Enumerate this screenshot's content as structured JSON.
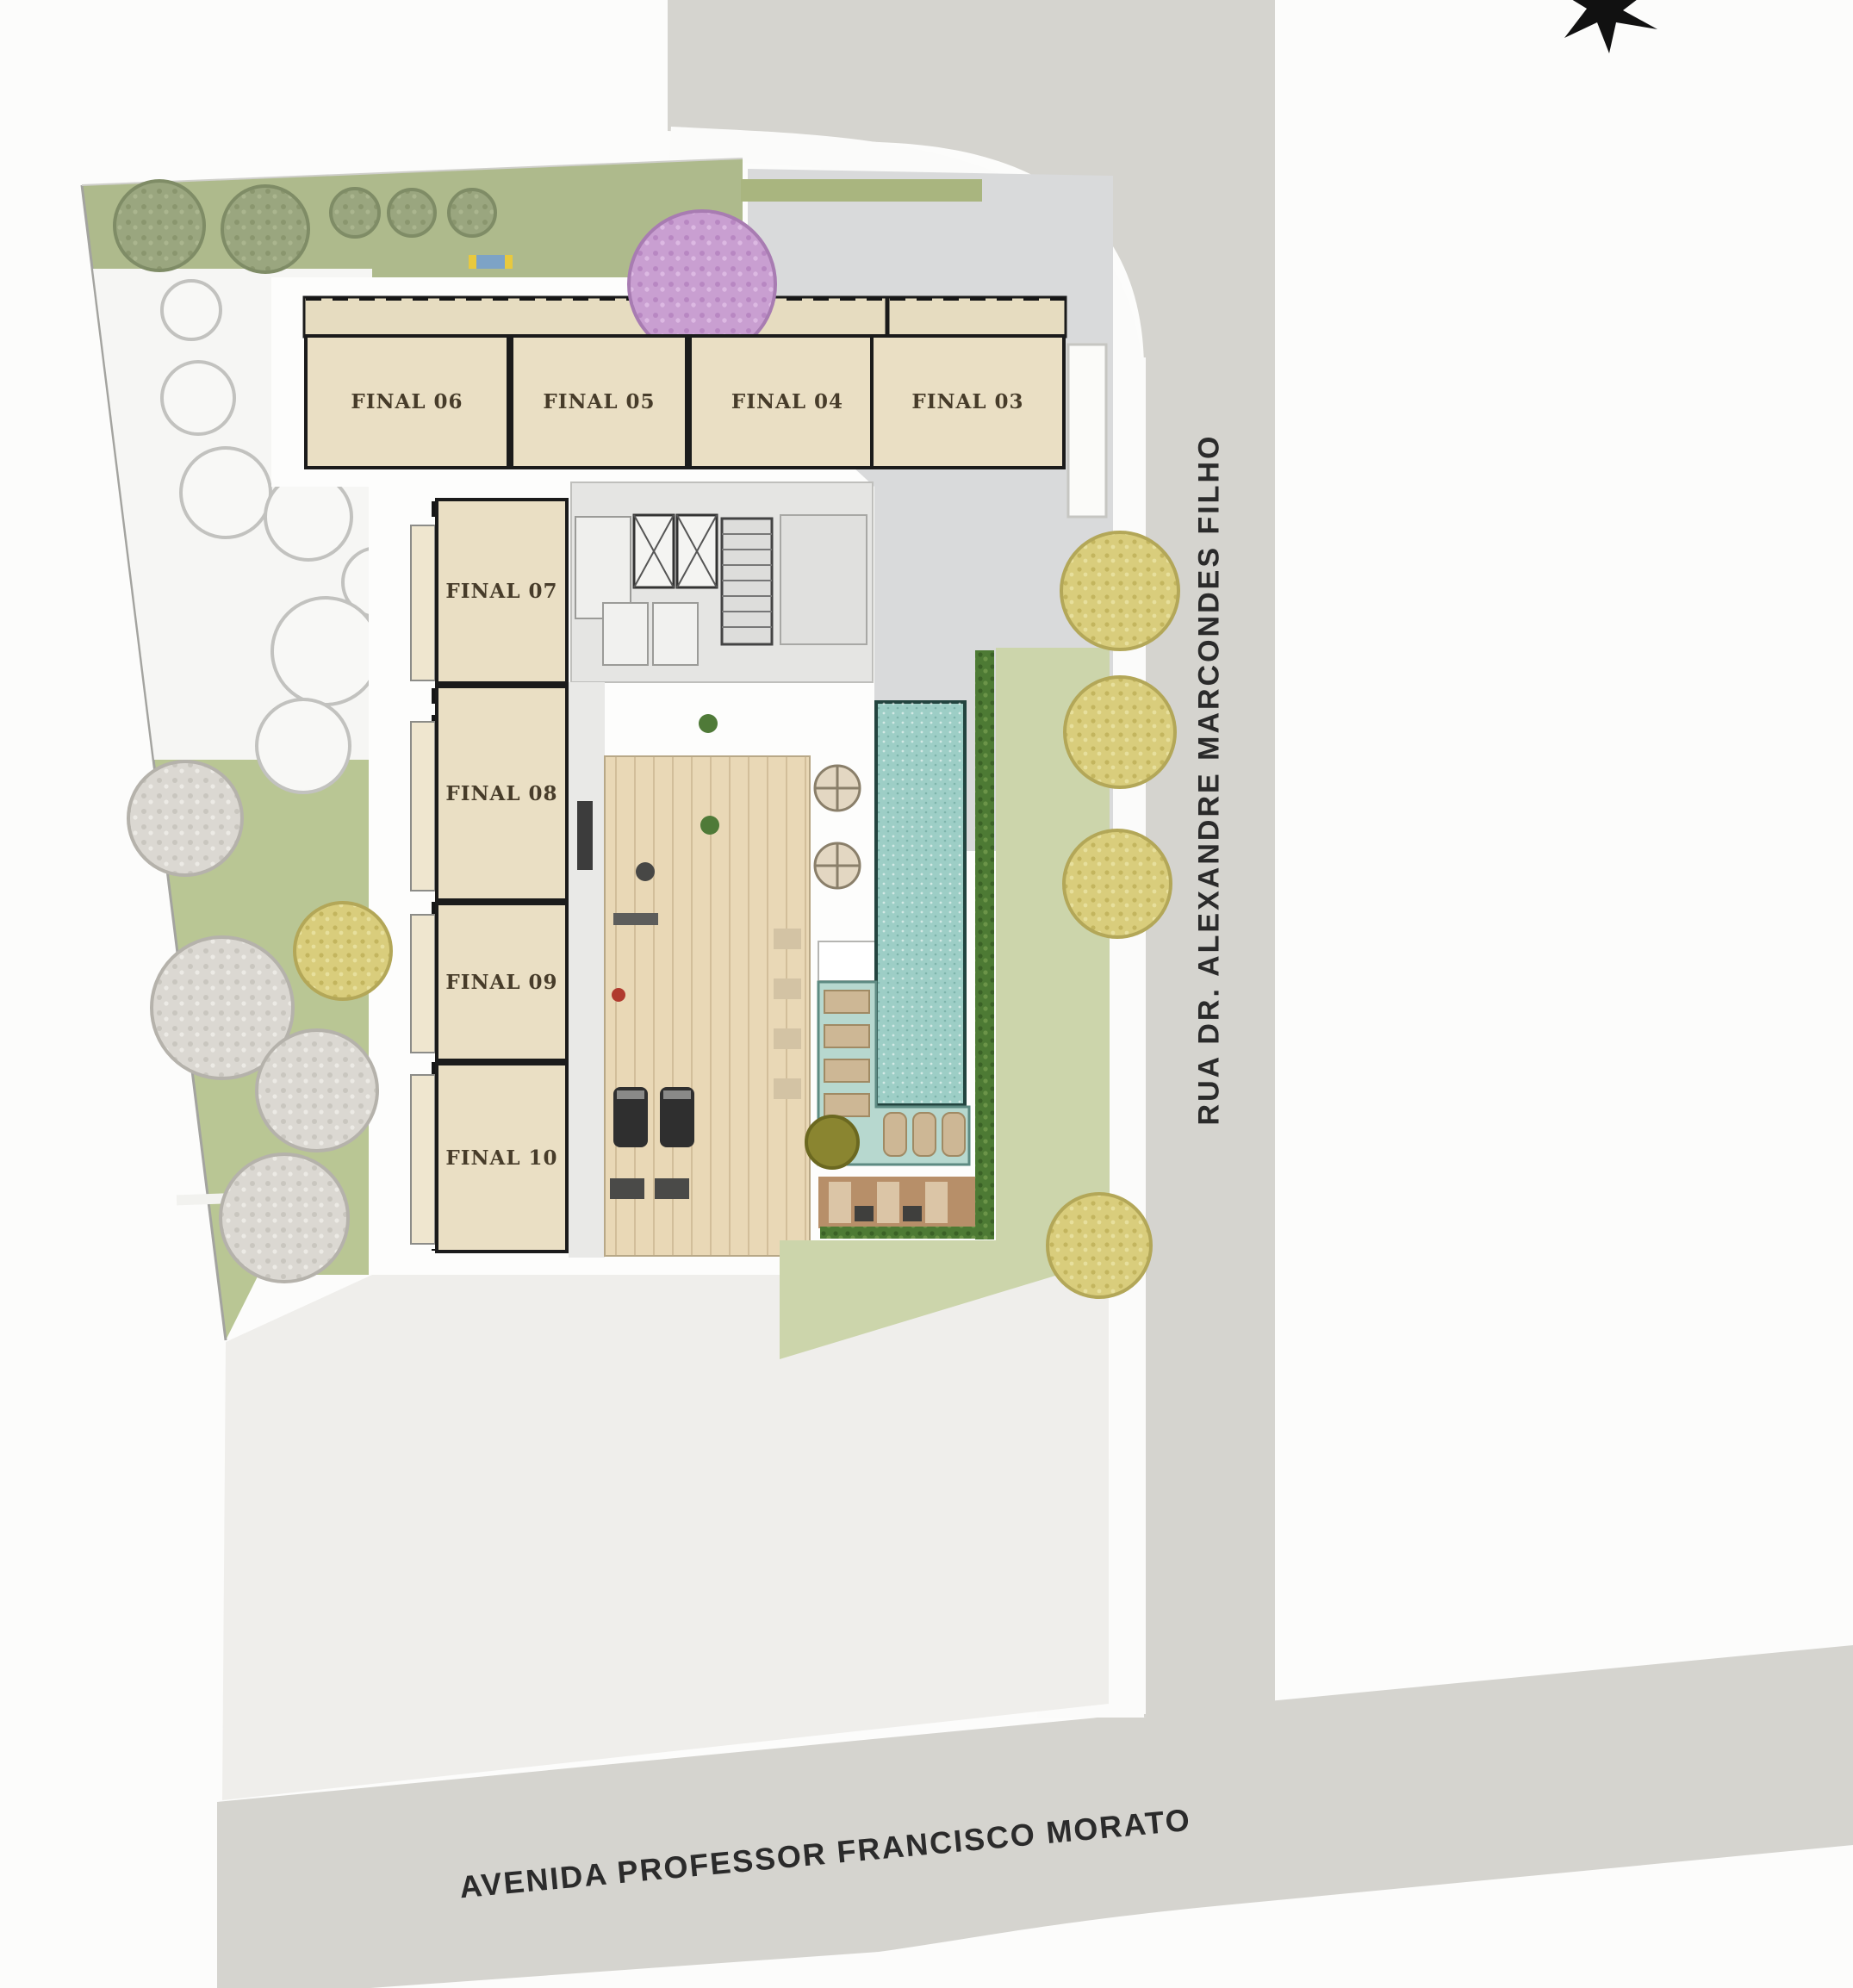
{
  "title": "Residential building site plan (implantação)",
  "streets": {
    "right_vertical_label": "RUA DR. ALEXANDRE MARCONDES FILHO",
    "bottom_label": "AVENIDA PROFESSOR FRANCISCO MORATO"
  },
  "units": [
    {
      "id": "final-06",
      "label": "FINAL 06"
    },
    {
      "id": "final-05",
      "label": "FINAL 05"
    },
    {
      "id": "final-04",
      "label": "FINAL 04"
    },
    {
      "id": "final-03",
      "label": "FINAL 03"
    },
    {
      "id": "final-07",
      "label": "FINAL 07"
    },
    {
      "id": "final-08",
      "label": "FINAL 08"
    },
    {
      "id": "final-09",
      "label": "FINAL 09"
    },
    {
      "id": "final-10",
      "label": "FINAL 10"
    }
  ],
  "features": {
    "compass": "north-star-icon",
    "pool": "swimming-pool",
    "pool_deck": "deck-with-loungers",
    "wood_deck": "wooden-deck",
    "gym": "gym-wood-floor",
    "elevators": "elevator-core",
    "stairs": "staircase",
    "playground": "playground-bench",
    "planters": "round-planters",
    "hedge": "hedge-row",
    "trees": [
      "sage-tree",
      "purple-tree",
      "pale-tree",
      "yellow-tree"
    ]
  },
  "colors": {
    "street": "#d5d4cf",
    "paving": "#efeeeb",
    "sidewalk": "#fbfbfa",
    "unit_fill": "#eadfc4",
    "wall": "#1b1b1b",
    "pool_water": "#9dcec6",
    "pool_deck": "#b7d8cf",
    "wood_deck": "#b78f69",
    "gym_floor": "#e9d8b6",
    "lawn_left": "#b9c694",
    "lawn_right": "#ccd5ab",
    "garden_top": "#aeba8c",
    "hedge": "#4d7a34",
    "tree_purple": "#c99fd1",
    "tree_yellow": "#d9cd7c",
    "forecourt": "#d9dadb"
  }
}
